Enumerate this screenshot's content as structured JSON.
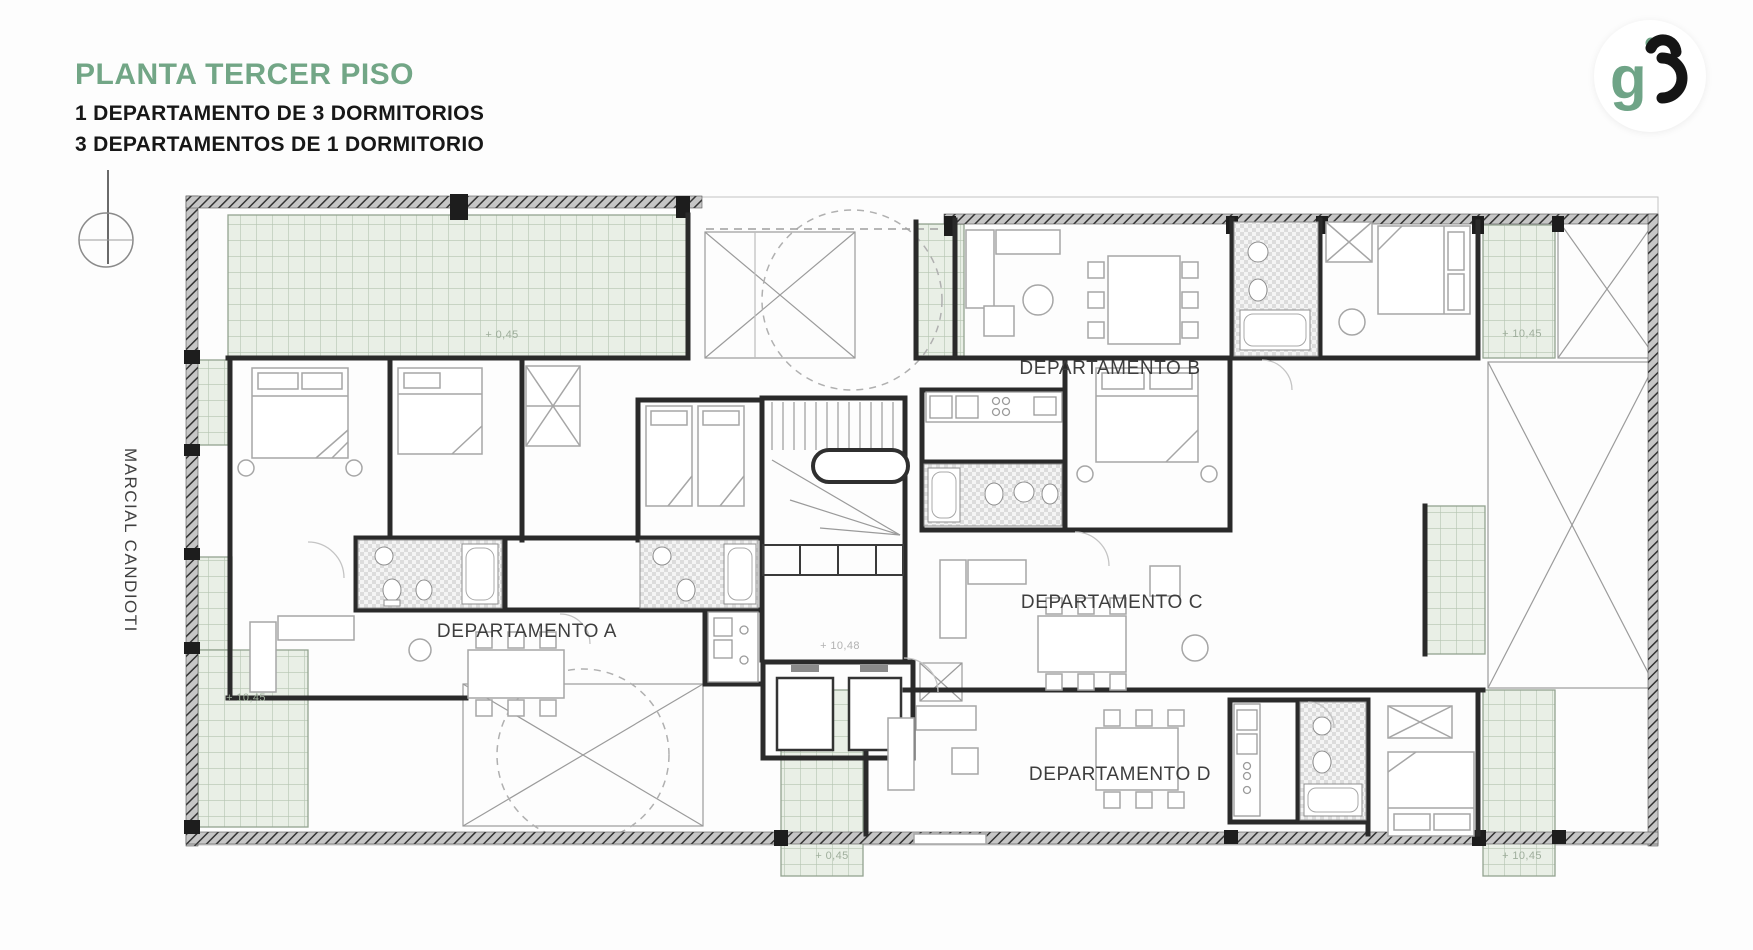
{
  "header": {
    "title": "PLANTA TERCER PISO",
    "subtitle_line1": "1 DEPARTAMENTO DE 3 DORMITORIOS",
    "subtitle_line2": "3 DEPARTAMENTOS DE 1 DORMITORIO"
  },
  "logo": {
    "letter_g": "g"
  },
  "side_label": "MARCIAL CANDIOTI",
  "plan": {
    "apartment_labels": [
      {
        "id": "A",
        "text": "DEPARTAMENTO A",
        "x": 527,
        "y": 632
      },
      {
        "id": "B",
        "text": "DEPARTAMENTO B",
        "x": 1110,
        "y": 369
      },
      {
        "id": "C",
        "text": "DEPARTAMENTO C",
        "x": 1112,
        "y": 603
      },
      {
        "id": "D",
        "text": "DEPARTAMENTO D",
        "x": 1120,
        "y": 775
      }
    ],
    "level_annotations": [
      {
        "text": "+ 0,45",
        "x": 502,
        "y": 335,
        "color": "#9fae9c"
      },
      {
        "text": "+ 10,45",
        "x": 1522,
        "y": 334,
        "color": "#9fae9c"
      },
      {
        "text": "+ 10,48",
        "x": 840,
        "y": 646,
        "color": "#b2b2b2"
      },
      {
        "text": "+ 10,45",
        "x": 246,
        "y": 698,
        "color": "#9fae9c"
      },
      {
        "text": "+ 0,45",
        "x": 832,
        "y": 856,
        "color": "#9fae9c"
      },
      {
        "text": "+ 10,45",
        "x": 1522,
        "y": 856,
        "color": "#9fae9c"
      }
    ]
  },
  "colors": {
    "title_green": "#72a686",
    "logo_green": "#6fa487",
    "terrace_fill": "#e9efe6",
    "terrace_grid": "#b4c4b1",
    "wall": "#2a2a2a",
    "light_line": "#a9a9a9",
    "label_text": "#3e3e3e"
  }
}
